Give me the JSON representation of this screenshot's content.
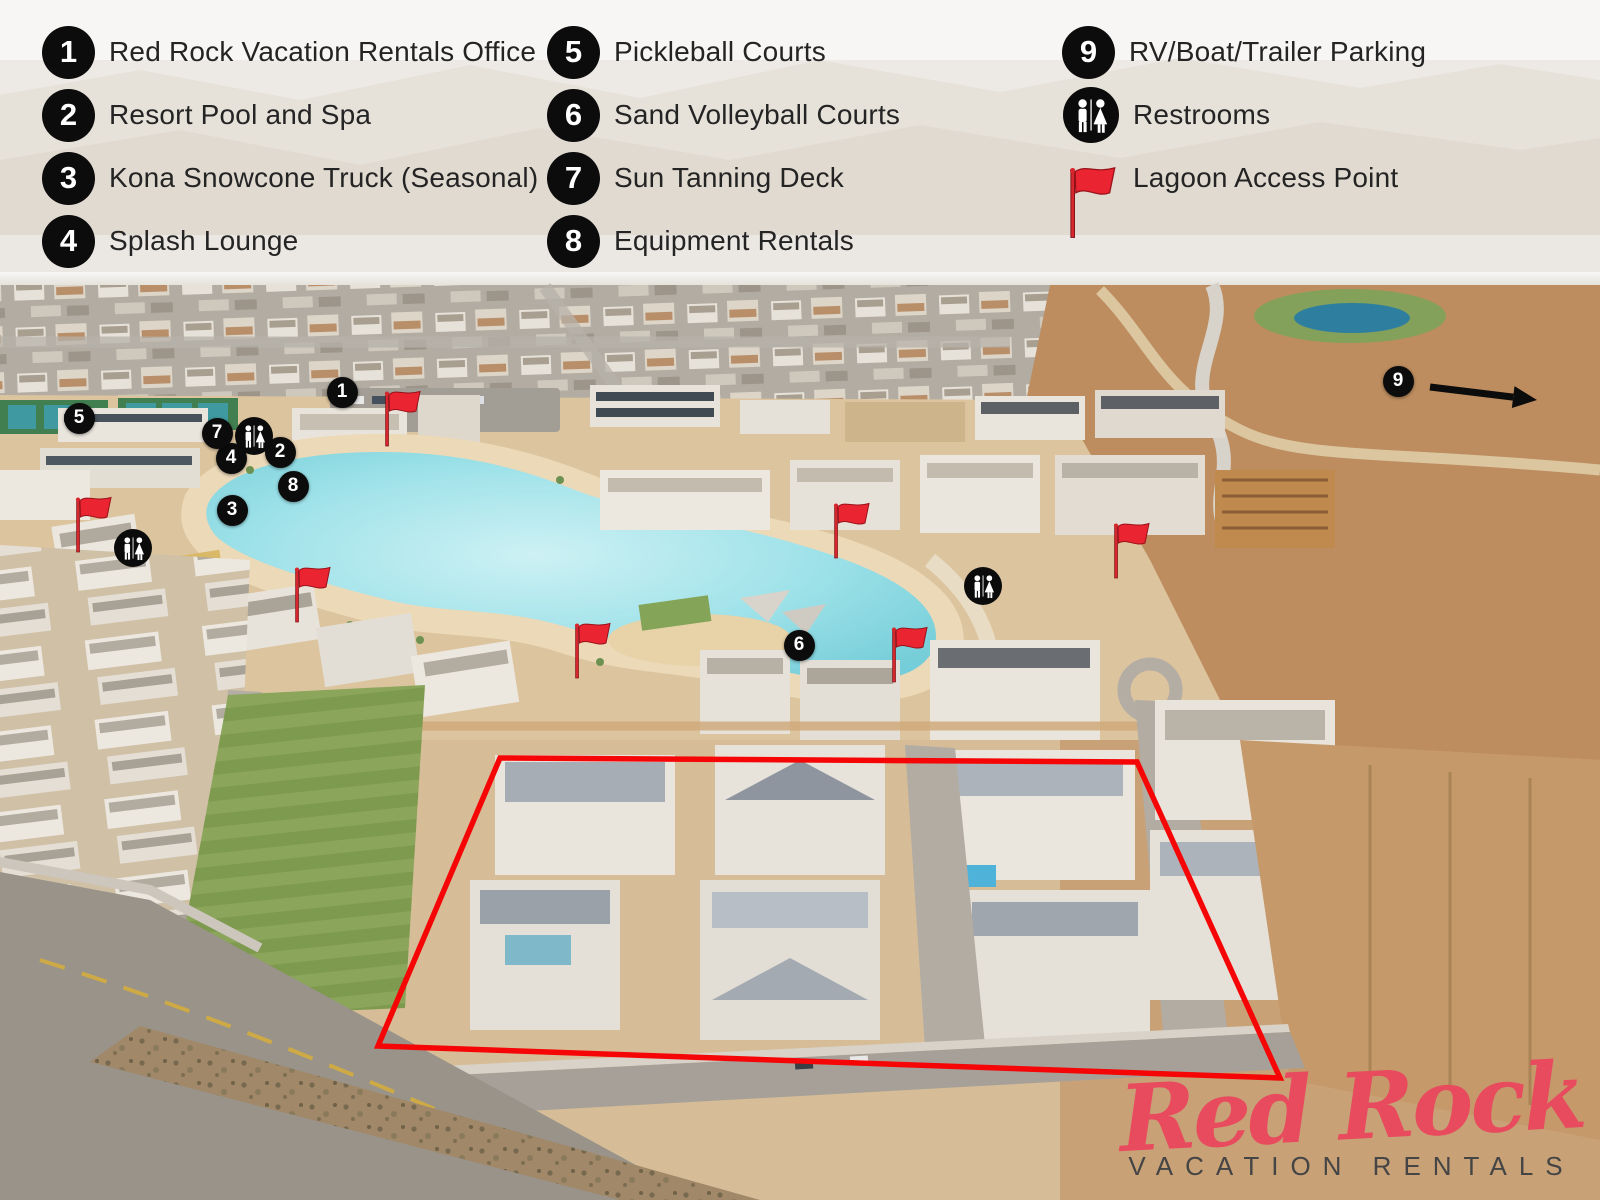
{
  "legend": {
    "columns": [
      {
        "items": [
          {
            "type": "number",
            "num": "1",
            "label": "Red Rock Vacation Rentals Office"
          },
          {
            "type": "number",
            "num": "2",
            "label": "Resort Pool and Spa"
          },
          {
            "type": "number",
            "num": "3",
            "label": "Kona Snowcone Truck (Seasonal)"
          },
          {
            "type": "number",
            "num": "4",
            "label": "Splash Lounge"
          }
        ]
      },
      {
        "items": [
          {
            "type": "number",
            "num": "5",
            "label": "Pickleball Courts"
          },
          {
            "type": "number",
            "num": "6",
            "label": "Sand Volleyball Courts"
          },
          {
            "type": "number",
            "num": "7",
            "label": "Sun Tanning Deck"
          },
          {
            "type": "number",
            "num": "8",
            "label": "Equipment Rentals"
          }
        ]
      },
      {
        "items": [
          {
            "type": "number",
            "num": "9",
            "label": "RV/Boat/Trailer Parking"
          },
          {
            "type": "restroom",
            "label": "Restrooms"
          },
          {
            "type": "flag",
            "label": "Lagoon Access Point"
          }
        ]
      }
    ]
  },
  "map": {
    "markers": [
      {
        "num": "1",
        "x": 342,
        "y": 392
      },
      {
        "num": "2",
        "x": 280,
        "y": 452
      },
      {
        "num": "3",
        "x": 232,
        "y": 510
      },
      {
        "num": "4",
        "x": 231,
        "y": 458
      },
      {
        "num": "5",
        "x": 79,
        "y": 418
      },
      {
        "num": "6",
        "x": 799,
        "y": 645
      },
      {
        "num": "7",
        "x": 217,
        "y": 433
      },
      {
        "num": "8",
        "x": 293,
        "y": 486
      },
      {
        "num": "9",
        "x": 1398,
        "y": 381
      }
    ],
    "restroom_badges": [
      {
        "x": 254,
        "y": 436
      },
      {
        "x": 133,
        "y": 548
      },
      {
        "x": 983,
        "y": 586
      }
    ],
    "flags": [
      {
        "x": 387,
        "y": 446
      },
      {
        "x": 78,
        "y": 552
      },
      {
        "x": 297,
        "y": 622
      },
      {
        "x": 577,
        "y": 678
      },
      {
        "x": 836,
        "y": 558
      },
      {
        "x": 894,
        "y": 682
      },
      {
        "x": 1116,
        "y": 578
      }
    ],
    "arrow": {
      "x1": 1430,
      "y1": 387,
      "x2": 1537,
      "y2": 400
    },
    "outline_points": "500,758 1137,762 1280,1078 378,1046",
    "colors": {
      "outline": "#f50505",
      "marker_bg": "#0c0c0c",
      "marker_text": "#ffffff",
      "flag": "#ea2430",
      "arrow": "#0c0c0c"
    }
  },
  "logo": {
    "script": "Red Rock",
    "subtitle": "VACATION RENTALS",
    "script_color": "#e84a5e",
    "subtitle_color": "#454545"
  }
}
